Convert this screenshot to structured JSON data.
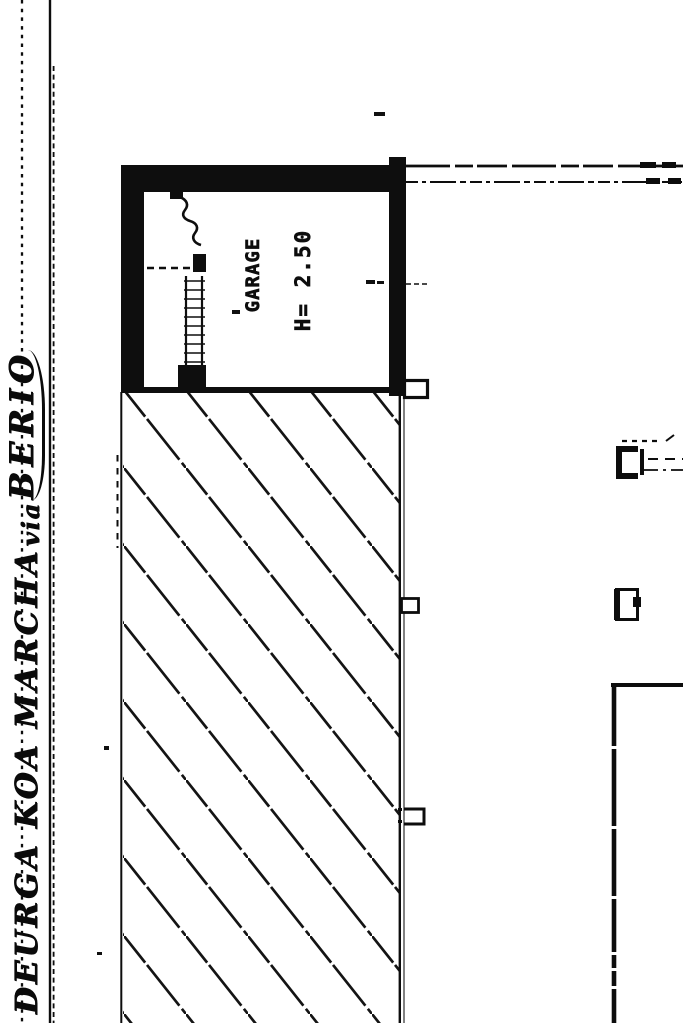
{
  "scan": {
    "handwriting": {
      "names": "DEURGA KOA MARCHA",
      "via": "via",
      "street": "BERIO"
    },
    "garage": {
      "label": "GARAGE",
      "height": "H= 2.50"
    }
  },
  "colors": {
    "ink": "#0d0d0d",
    "paper": "#ffffff"
  }
}
